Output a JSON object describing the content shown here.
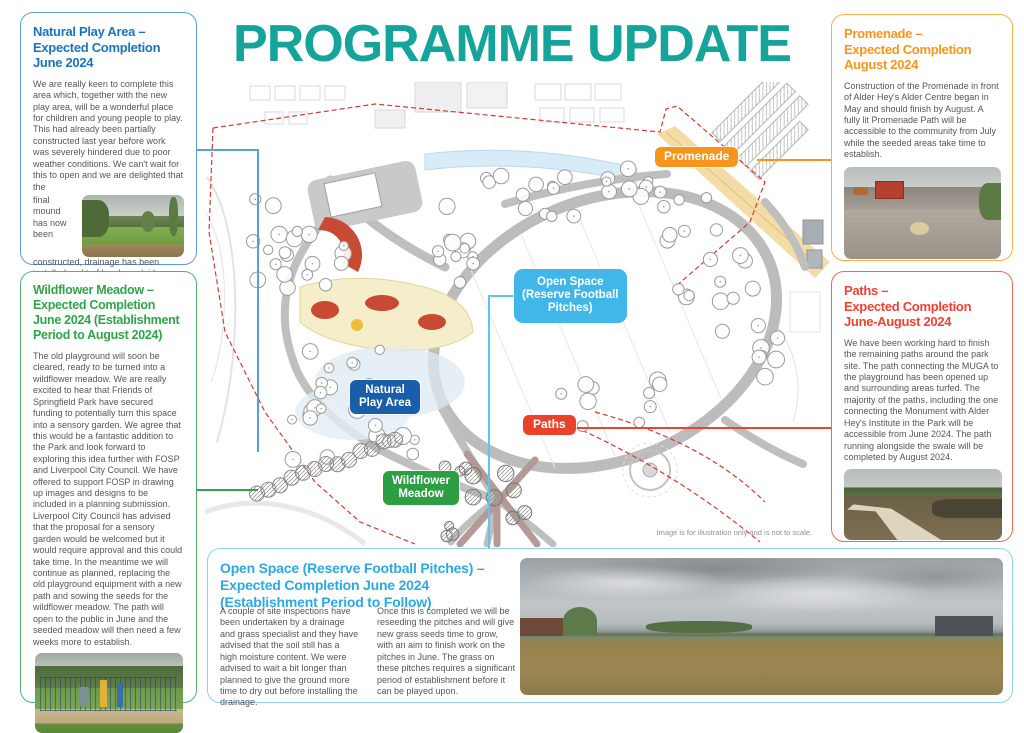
{
  "title": "PROGRAMME UPDATE",
  "caption": "Image is for illustration only and is not to scale.",
  "colors": {
    "teal": "#16A39A",
    "blue": "#1B75BC",
    "green": "#2FA44B",
    "orange": "#F7941E",
    "red": "#EF4130",
    "light_blue": "#2BA9E0"
  },
  "boxes": {
    "natural_play": {
      "heading": "Natural Play Area –\nExpected Completion\nJune 2024",
      "body_1": "We are really keen to complete this area which, together with the new play area, will be a wonderful place for children and young people to play. This had already been partially constructed last year before work was severely hindered due to poor weather conditions. We can't wait for this to open and we are delighted that the",
      "body_2": "final mound has now been constructed, drainage has been installed and turf has been laid.",
      "photo_name": "natural-play-area-site-photo"
    },
    "wildflower": {
      "heading": "Wildflower Meadow –\nExpected Completion\nJune 2024 (Establishment\nPeriod to August 2024)",
      "body": "The old playground will soon be cleared, ready to be turned into a wildflower meadow. We are really excited to hear that Friends of Springfield Park have secured funding to potentially turn this space into a sensory garden. We agree that this would be a fantastic addition to the Park and look forward to exploring this idea further with FOSP and Liverpool City Council. We have offered to support FOSP in drawing up images and designs to be included in a planning submission. Liverpool City Council has advised that the proposal for a sensory garden would be welcomed but it would require approval and this could take time. In the meantime we will continue as planned, replacing the old playground equipment with a new path and sowing the seeds for the wildflower meadow. The path will open to the public in June and the seeded meadow will then need a few weeks more to establish.",
      "photo_name": "old-playground-photo"
    },
    "promenade": {
      "heading": "Promenade –\nExpected Completion\nAugust 2024",
      "body": "Construction of the Promenade in front of Alder Hey's Alder Centre began in May and should finish by August. A fully lit Promenade Path will be accessible to the community from July while the seeded areas take time to establish.",
      "photo_name": "promenade-construction-photo"
    },
    "paths": {
      "heading": "Paths –\nExpected Completion\nJune-August 2024",
      "body": "We have been working hard to finish the remaining paths around the park site. The path connecting the MUGA to the playground has been opened up and surrounding areas turfed. The majority of the paths, including the one connecting the Monument with Alder Hey's Institute in the Park will be accessible from June 2024. The path running alongside the swale will be completed by August 2024.",
      "photo_name": "new-path-photo"
    },
    "open_space": {
      "heading": "Open Space (Reserve Football Pitches) –\nExpected Completion June 2024\n(Establishment Period to Follow)",
      "col_1": "A couple of site inspections have been undertaken by a drainage and grass specialist and they have advised that the soil still has a high moisture content. We were advised to wait a bit longer than planned to give the ground more time to dry out before installing the drainage.",
      "col_2": "Once this is completed we will be reseeding the pitches and will give new grass seeds time to grow, with an aim to finish work on the pitches in June. The grass on these pitches requires a significant period of establishment before it can be played upon.",
      "photo_name": "open-space-field-photo"
    }
  },
  "map_labels": {
    "promenade": "Promenade",
    "open_space": "Open Space\n(Reserve Football\nPitches)",
    "natural_play": "Natural\nPlay Area",
    "paths": "Paths",
    "wildflower": "Wildflower\nMeadow"
  }
}
